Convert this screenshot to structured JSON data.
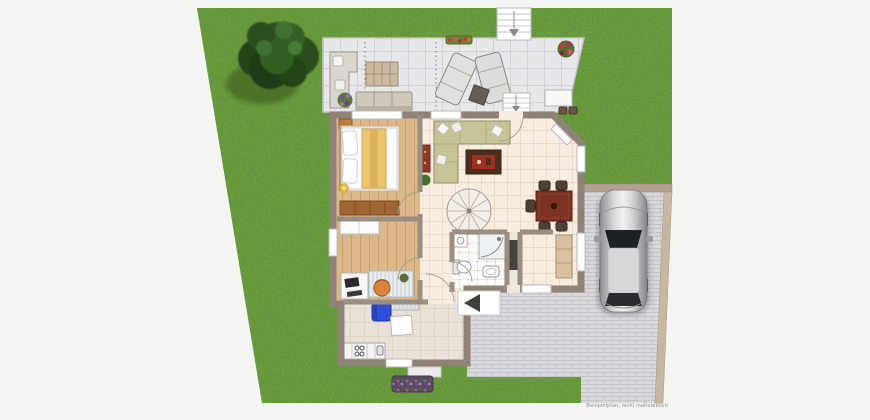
{
  "page": {
    "width": 870,
    "height": 420,
    "disclaimer": "Beispielplan, nicht maßstäblich"
  },
  "palette": {
    "background": "#f4f4f2",
    "lawn_green": "#74a843",
    "tree_green": "#2d5323",
    "terrace_tile": "#e7e7e9",
    "house_wall": "#8f8378",
    "wood_floor": "#dcb888",
    "living_tile": "#f6ecdf",
    "bathroom_tile": "#fcfbfa",
    "kitchen_floor": "#e8e1d7",
    "paving_gray": "#d8d7d9",
    "paving_edge_tan": "#c6b7a2",
    "car_silver": "#c9c9c9",
    "chair_blue": "#2e4fd6",
    "chair_orange": "#d8833b",
    "dining_table_brown": "#7c3322",
    "sideboard_brown": "#9f6434",
    "flowers_purple": "#8a5f9a",
    "flowers_red": "#c03a3a"
  },
  "scene": {
    "garden": {
      "elements": [
        "lawn",
        "large-tree",
        "purple-flower-bed",
        "garden-stairs"
      ]
    },
    "terrace": {
      "furniture": [
        "corner-sofa",
        "outdoor-table",
        "bench-sofa",
        "potted-plant",
        "sun-lounger-left",
        "sun-lounger-right",
        "side-table",
        "flower-box",
        "flower-pot",
        "bistro-table",
        "stools",
        "terrace-stairs"
      ]
    },
    "house": {
      "rooms": [
        "bedroom",
        "study",
        "living-room",
        "dining-area",
        "hallway",
        "bathroom",
        "entry",
        "kitchen"
      ],
      "bedroom": [
        "double-bed",
        "pillows",
        "yellow-blanket",
        "bedside-lamp",
        "sideboard",
        "rug"
      ],
      "study": [
        "white-wardrobe",
        "desk",
        "computer",
        "office-chair",
        "shelf-unit",
        "plant"
      ],
      "living_room": [
        "corner-sofa",
        "coffee-table",
        "red-cabinet",
        "plant",
        "spiral-staircase"
      ],
      "dining_area": [
        "dining-table",
        "five-chairs"
      ],
      "bathroom": [
        "shower",
        "toilet",
        "washbasin",
        "washing-machine"
      ],
      "entry": [
        "wardrobe",
        "doormat"
      ],
      "kitchen": [
        "kitchen-counter",
        "stove",
        "sink",
        "small-table",
        "blue-armchair",
        "radiator"
      ]
    },
    "driveway": {
      "elements": [
        "paved-driveway",
        "car",
        "front-walk",
        "entrance-platform",
        "entrance-arrow"
      ]
    }
  }
}
